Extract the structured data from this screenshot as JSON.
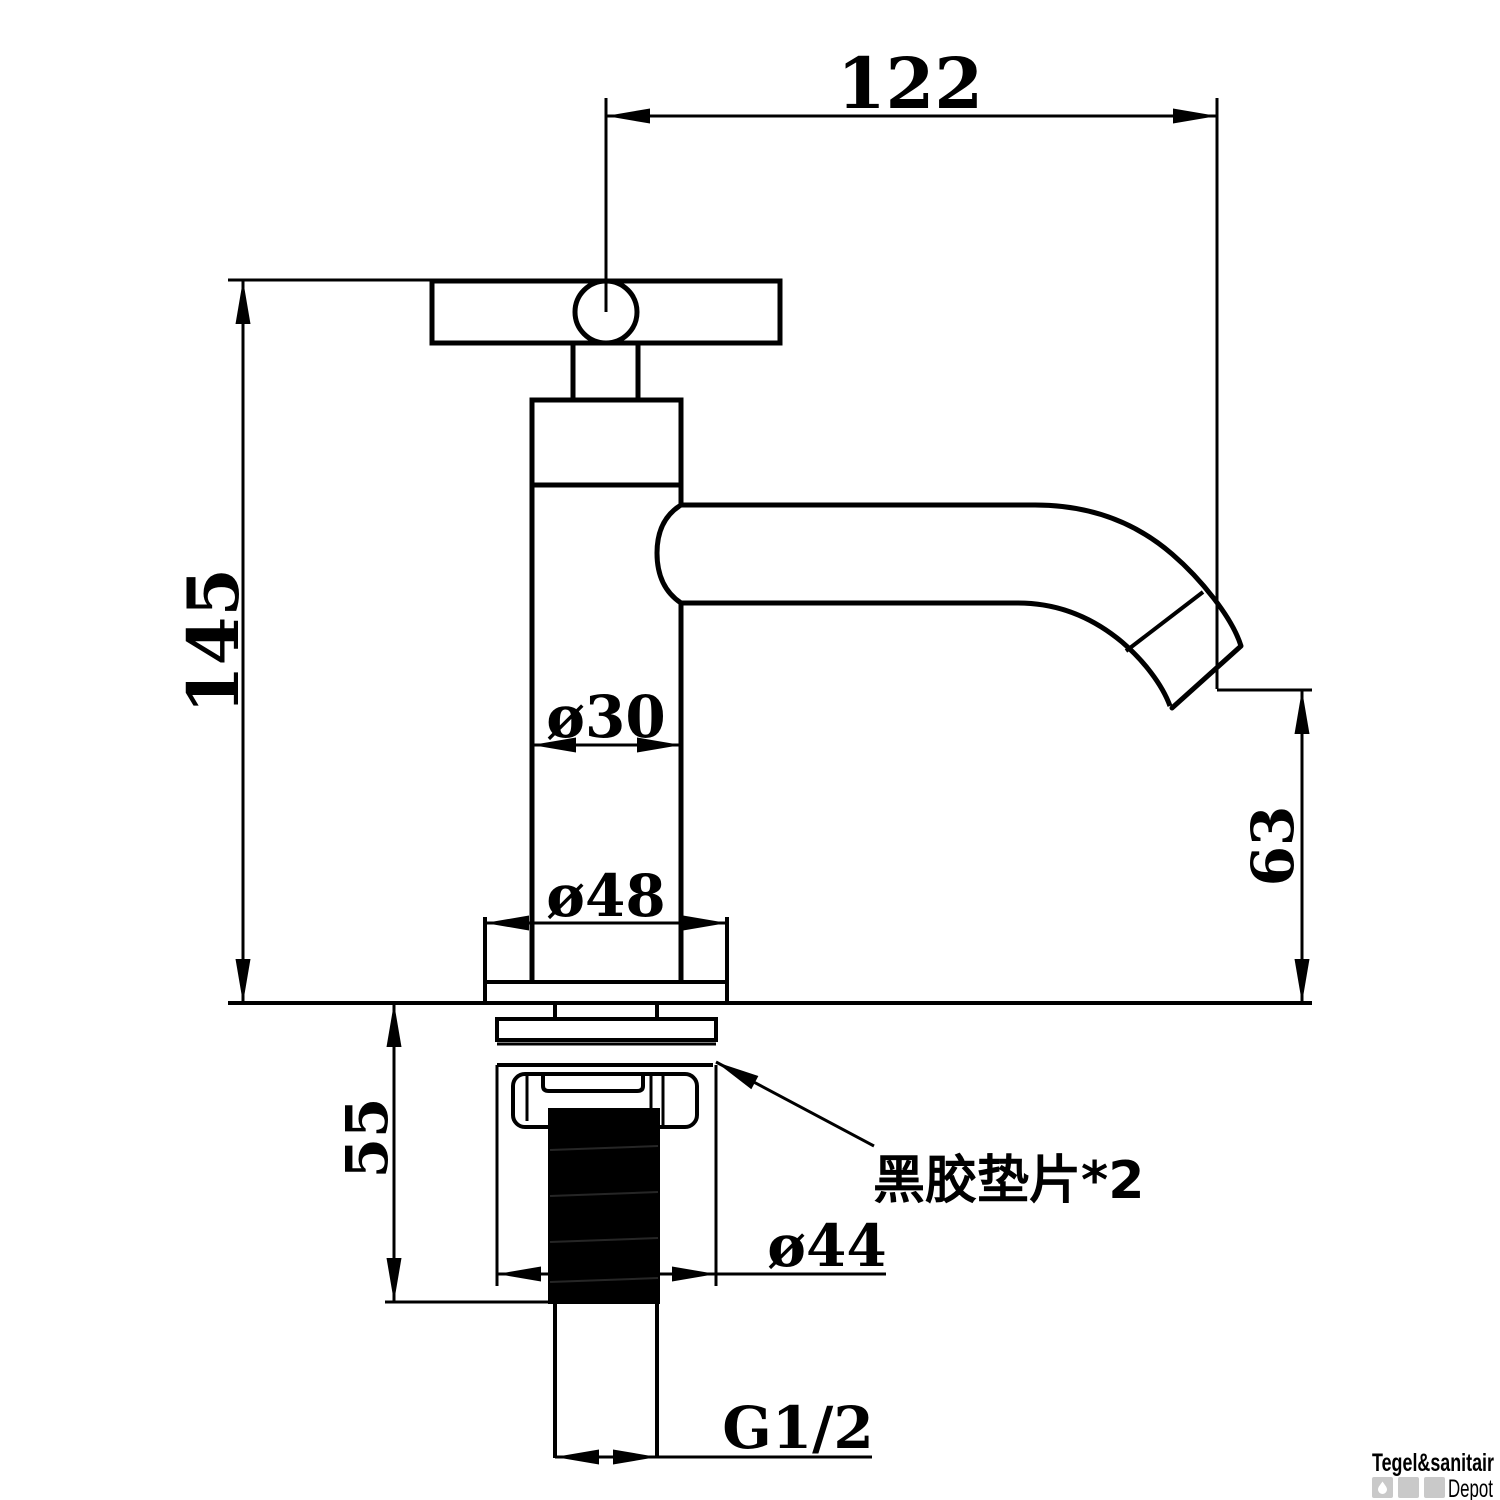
{
  "drawing": {
    "type": "faucet-technical-dimension-drawing",
    "dimensions": {
      "spout_reach": {
        "label": "122"
      },
      "total_height": {
        "label": "145"
      },
      "body_diameter": {
        "label": "ø30"
      },
      "base_diameter": {
        "label": "ø48"
      },
      "spout_outlet_height": {
        "label": "63"
      },
      "under_deck_length": {
        "label": "55"
      },
      "washer_diameter": {
        "label": "ø44"
      },
      "thread_size": {
        "label": "G1/2"
      }
    },
    "note": {
      "text": "黑胶垫片*2"
    },
    "colors": {
      "line": "#000000",
      "background": "#ffffff",
      "watermark_gray": "#c2c2c2",
      "watermark_square": "#c9c9c9",
      "watermark_light": "#d8d8d8"
    }
  },
  "watermark": {
    "brand": "Tegel&sanitair",
    "sub": "Depot"
  }
}
